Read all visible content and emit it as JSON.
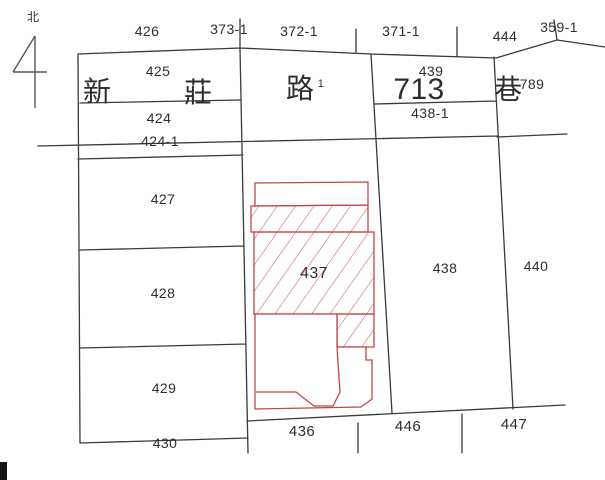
{
  "north": {
    "label": "北"
  },
  "road": {
    "name_chars": [
      "新",
      "莊",
      "路"
    ],
    "superscript": "1",
    "lane_number": "713",
    "lane_char": "巷",
    "right_number": "789"
  },
  "parcels": {
    "p426": "426",
    "p373_1": "373-1",
    "p372_1": "372-1",
    "p371_1": "371-1",
    "p444": "444",
    "p359_1": "359-1",
    "p425": "425",
    "p439": "439",
    "p438_1": "438-1",
    "p424": "424",
    "p424_1": "424-1",
    "p427": "427",
    "p428": "428",
    "p429": "429",
    "p430": "430",
    "p437": "437",
    "p438": "438",
    "p440": "440",
    "p436": "436",
    "p446": "446",
    "p447": "447"
  },
  "colors": {
    "parcel_line": "#3a3a3a",
    "building_outline": "#c24744",
    "building_hatch": "#cf5a55",
    "text": "#2e2e2e",
    "north_arrow": "#555555"
  }
}
